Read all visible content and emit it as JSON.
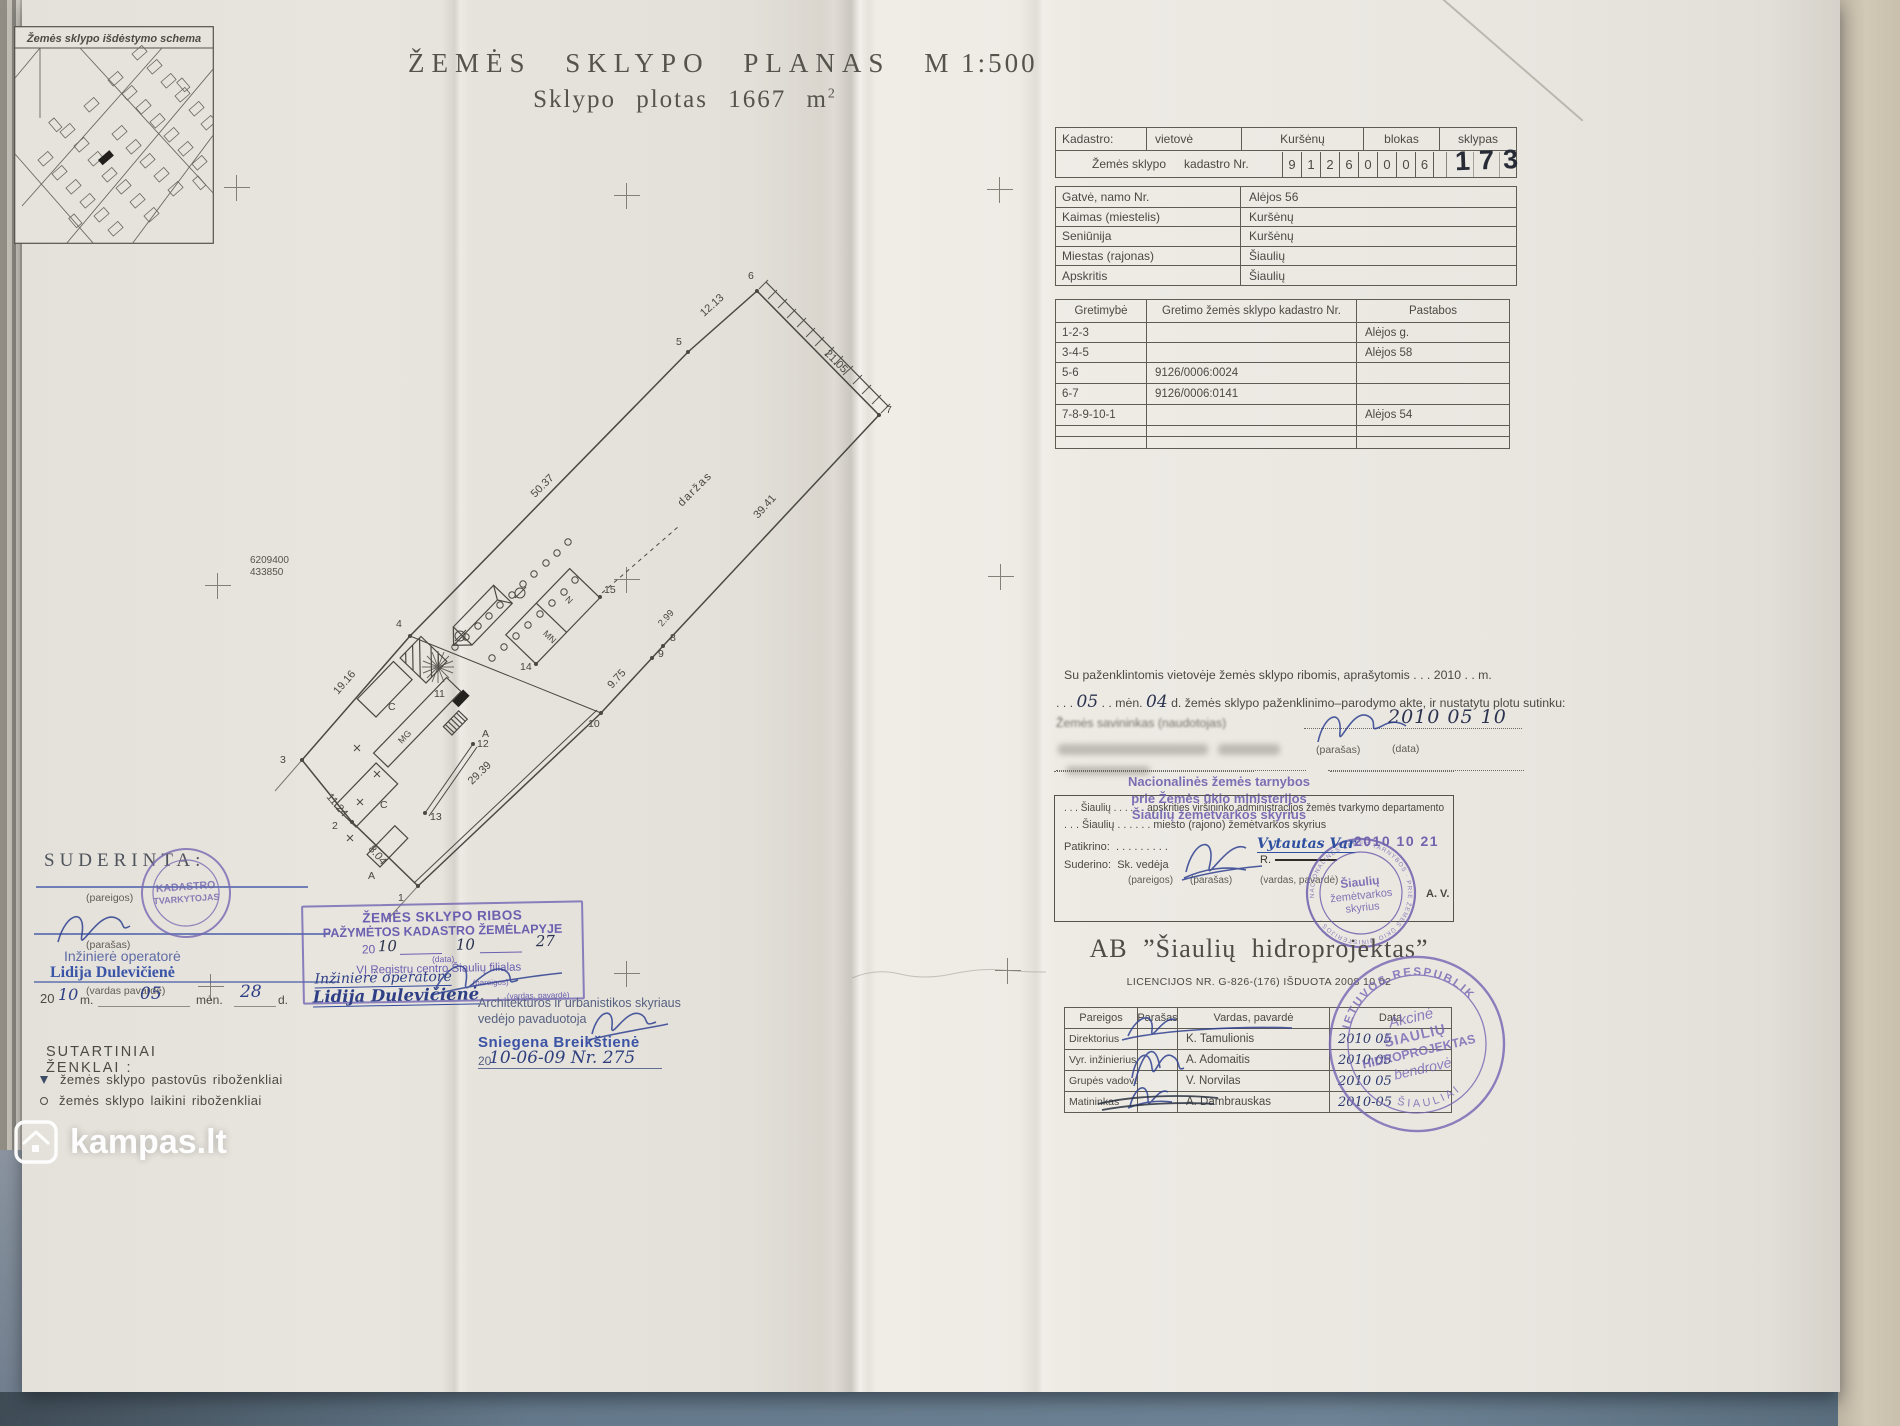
{
  "watermark": {
    "brand": "kampas.lt"
  },
  "plan": {
    "heading": "ŽEMĖS  SKLYPO  PLANAS",
    "scale": "M 1:500",
    "area_prefix": "Sklypo  plotas",
    "area_value": "1667",
    "area_unit": "m",
    "area_exp": "2"
  },
  "inset": {
    "title": "Žemės sklypo išdėstymo schema"
  },
  "cadastre": {
    "label": "Kadastro:",
    "vietove_label": "vietovė",
    "vietove_value": "Kuršėnų",
    "blokas_label": "blokas",
    "sklypas_label": "sklypas",
    "row_label_1": "Žemės sklypo",
    "row_label_2": "kadastro Nr.",
    "digits": [
      "9",
      "1",
      "2",
      "6",
      "0",
      "0",
      "0",
      "6"
    ],
    "sklypas_value": "173"
  },
  "address": {
    "rows": [
      {
        "label": "Gatvė, namo Nr.",
        "value": "Alėjos 56"
      },
      {
        "label": "Kaimas (miestelis)",
        "value": "Kuršėnų"
      },
      {
        "label": "Seniūnija",
        "value": "Kuršėnų"
      },
      {
        "label": "Miestas (rajonas)",
        "value": "Šiaulių"
      },
      {
        "label": "Apskritis",
        "value": "Šiaulių"
      }
    ]
  },
  "gretimybe": {
    "headers": [
      "Gretimybė",
      "Gretimo žemės sklypo kadastro Nr.",
      "Pastabos"
    ],
    "rows": [
      {
        "c0": "1-2-3",
        "c1": "",
        "c2": "Alėjos g."
      },
      {
        "c0": "3-4-5",
        "c1": "",
        "c2": "Alėjos 58"
      },
      {
        "c0": "5-6",
        "c1": "9126/0006:0024",
        "c2": ""
      },
      {
        "c0": "6-7",
        "c1": "9126/0006:0141",
        "c2": ""
      },
      {
        "c0": "7-8-9-10-1",
        "c1": "",
        "c2": "Alėjos 54"
      },
      {
        "c0": "",
        "c1": "",
        "c2": ""
      },
      {
        "c0": "",
        "c1": "",
        "c2": ""
      }
    ]
  },
  "consent": {
    "line1": "Su paženklintomis vietovėje žemės sklypo ribomis, aprašytomis . . . 2010 . . m.",
    "line2_pre": ". . .",
    "hw_month": "05",
    "line2_mid": ". . mėn.",
    "hw_day": "04",
    "line2_post": "d. žemės sklypo paženklinimo–parodymo akte, ir nustatytu plotu sutinku:",
    "owner_label": "Žemės savininkas (naudotojas)",
    "hw_date": "2010 05 10",
    "parasas_label": "(parašas)",
    "data_label": "(data)"
  },
  "national": {
    "stamp_line1": "Nacionalinės žemės tarnybos",
    "stamp_line2": "prie Žemės ūkio ministerijos",
    "stamp_line3": "Šiaulių žemėtvarkos skyrius",
    "line1": ". . . Šiaulių . . . . . .  apskrities viršininko administracijos žemės tvarkymo departamento",
    "line2": ". . . Šiaulių . . . . . .  miesto (rajono) žemėtvarkos skyrius",
    "patikrino_label": "Patikrino:",
    "patikrino_dots": ". . . . . . . . .",
    "suderino_label": "Suderino:",
    "suderino_role": "Sk. vedėja",
    "stamped_name": "Vytautas Var",
    "struck_name": "R.",
    "stamped_date": "2010 10 21",
    "pareigos_label": "(pareigos)",
    "parasas_label": "(parašas)",
    "vardas_label": "(vardas, pavardė)",
    "round_stamp": {
      "l1": "Šiaulių",
      "l2": "žemėtvarkos",
      "l3": "skyrius",
      "ring": "NACIONALINĖS ŽEMĖS TARNYBOS · PRIE ŽEMĖS ŪKIO MINISTERIJOS ·"
    },
    "av_label": "A. V."
  },
  "company": {
    "name": "AB  ”Šiaulių  hidroprojektas”",
    "license": "LICENCIJOS NR. G-826-(176) IŠDUOTA 2008 10 02",
    "headers": [
      "Pareigos",
      "Parašas",
      "Vardas, pavardė",
      "Data"
    ],
    "rows": [
      {
        "role": "Direktorius",
        "name": "K. Tamulionis",
        "date": "2010 05"
      },
      {
        "role": "Vyr. inžinierius",
        "name": "A. Adomaitis",
        "date": "2010.05"
      },
      {
        "role": "Grupės vadovas",
        "name": "V. Norvilas",
        "date": "2010 05"
      },
      {
        "role": "Matininkas",
        "name": "A. Dambrauskas",
        "date": "2010-05"
      }
    ],
    "stamp": {
      "arc_top": "LIETUVOS RESPUBLIKA",
      "line1": "Akcinė",
      "line2": "ŠIAULIŲ",
      "line3": "HIDROPROJEKTAS",
      "line4": "bendrovė",
      "arc_bottom": "ŠIAULIAI"
    }
  },
  "suderinta": {
    "title": "SUDERINTA:",
    "pareigos_label": "(pareigos)",
    "parasas_label": "(parašas)",
    "role": "Inžinierė operatorė",
    "name": "Lidija Dulevičienė",
    "vardas_label": "(vardas pavardė)",
    "year_prefix": "20",
    "hw_year": "10",
    "m_label": "m.",
    "hw_month": "05",
    "men_label": "mėn.",
    "hw_day": "28",
    "d_label": "d.",
    "stamp_line1": "KADASTRO",
    "stamp_line2": "TVARKYTOJAS"
  },
  "border_stamp": {
    "line1": "ŽEMĖS SKLYPO RIBOS",
    "line2": "PAŽYMĖTOS KADASTRO ŽEMĖLAPYJE",
    "year_prefix": "20",
    "hw_year": "10",
    "hw_month": "10",
    "hw_day": "27",
    "data_label": "(data)",
    "org": "VĮ Registrų centro Šiaulių filialas",
    "role": "Inžinierė operatorė",
    "name": "Lidija Dulevičienė",
    "pareigos_label": "(pareigos)",
    "vardas_label": "(vardas, pavardė)"
  },
  "architect": {
    "line1": "Architektūros ir urbanistikos skyriaus",
    "line2": "vedėjo pavaduotoja",
    "name": "Sniegena Breikštienė",
    "year_prefix": "20",
    "hw_date": "10-06-09  Nr. 275"
  },
  "legend": {
    "title": "SUTARTINIAI ŽENKLAI :",
    "items": [
      {
        "label": "žemės sklypo pastovūs riboženkliai"
      },
      {
        "label": "žemės sklypo laikini riboženkliai"
      }
    ]
  },
  "plot": {
    "area_label": "daržas",
    "coord_n": "6209400",
    "coord_e": "433850",
    "dims": {
      "d_3_4": "19.16",
      "d_4_5": "50.37",
      "d_5_6": "12.13",
      "d_6_7": "21.05",
      "d_7_8": "39.41",
      "d_8_9": "2.99",
      "d_9_10": "9.75",
      "d_10_1": "29.39",
      "d_2_3": "11.24",
      "d_1_2": "8.04"
    },
    "vertices": {
      "v1": "1",
      "v2": "2",
      "v3": "3",
      "v4": "4",
      "v5": "5",
      "v6": "6",
      "v7": "7",
      "v8": "8",
      "v9": "9",
      "v10": "10",
      "v11": "11",
      "v12": "12",
      "v13": "13",
      "v14": "14",
      "v15": "15"
    },
    "buildings": {
      "mg": "MG",
      "mn": "MN",
      "n": "N",
      "c_upper": "C",
      "c_lower": "C",
      "a_east": "A",
      "a_south": "A"
    }
  }
}
